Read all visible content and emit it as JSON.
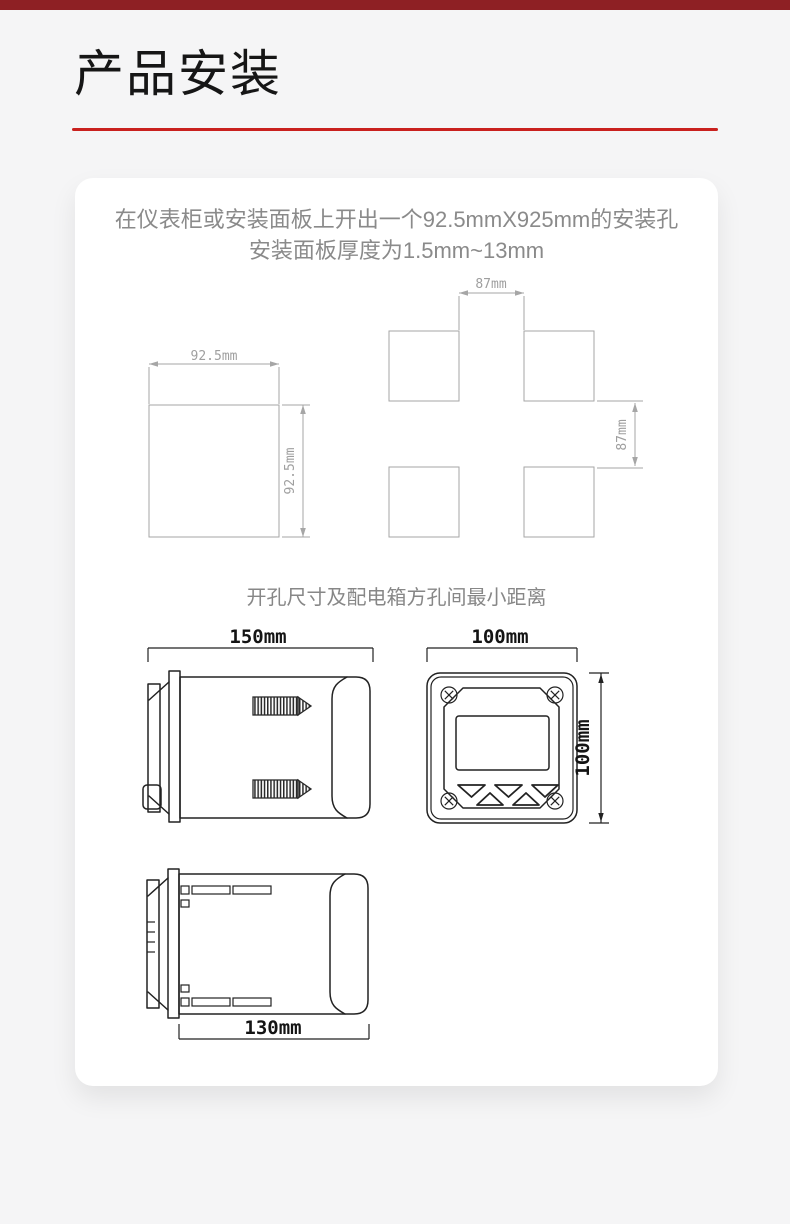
{
  "page": {
    "title": "产品安装",
    "accent_color": "#c9211e",
    "top_bar_color": "#8e2024",
    "background_color": "#f5f5f6"
  },
  "card": {
    "intro_line1": "在仪表柜或安装面板上开出一个92.5mmX925mm的安装孔",
    "intro_line2": "安装面板厚度为1.5mm~13mm",
    "caption": "开孔尺寸及配电箱方孔间最小距离"
  },
  "diagrams": {
    "cutout_square": {
      "width_label": "92.5mm",
      "height_label": "92.5mm"
    },
    "hole_spacing": {
      "gap_width_label": "87mm",
      "gap_height_label": "87mm"
    },
    "side_view_top": {
      "width_label": "150mm"
    },
    "front_view": {
      "width_label": "100mm",
      "height_label": "100mm"
    },
    "side_view_bottom": {
      "width_label": "130mm"
    }
  }
}
